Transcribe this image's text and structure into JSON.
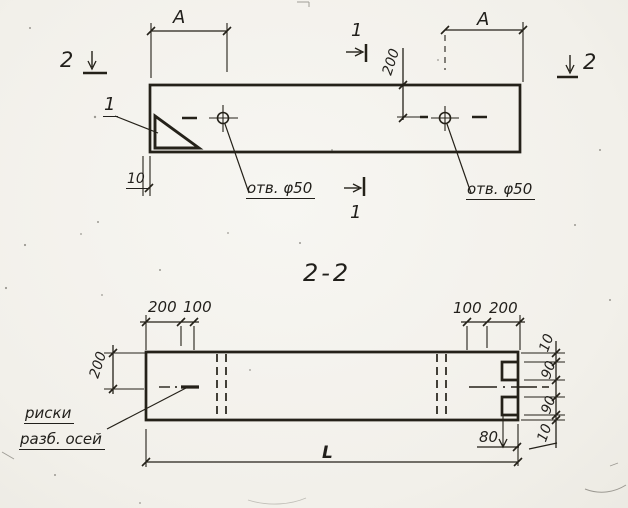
{
  "palette": {
    "paper": "#f4f2ed",
    "ink": "#211f1b"
  },
  "plan_view": {
    "dim_a_left": "A",
    "dim_a_right": "A",
    "section1_top_label": "1",
    "section1_bottom_label": "1",
    "section2_left_label": "2",
    "section2_right_label": "2",
    "detail_callout_label": "1",
    "dim_hole_offset": "200",
    "dim_edge_gap": "10",
    "hole_left_label": "отв. φ50",
    "hole_right_label": "отв. φ50"
  },
  "section_view": {
    "title": "2-2",
    "top_left_dims": [
      "200",
      "100"
    ],
    "top_right_dims": [
      "100",
      "200"
    ],
    "side_dim": "200",
    "right_chain_dims": [
      "10",
      "90",
      "90",
      "10"
    ],
    "notch_depth_dim": "80",
    "length_dim": "L",
    "axis_note_line1": "риски",
    "axis_note_line2": "разб. осей"
  }
}
